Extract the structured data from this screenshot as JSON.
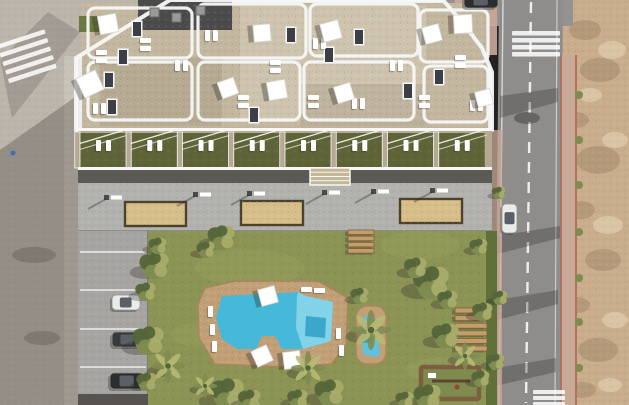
{
  "scene": {
    "title": "aerial-render-apartment-complex-with-pool",
    "type": "3d-architectural-render",
    "view": "top-down"
  },
  "palette": {
    "road_left": "#bcb5ac",
    "sidewalk_left": "#c9c2b8",
    "road_right": "#8e8d8b",
    "road_top": "#95938f",
    "dirt": "#c9ad8c",
    "dirt_dark": "#9f8868",
    "dirt_light": "#e4d4b6",
    "sidewalk_pink": "#c9a998",
    "curb_red": "#ad7560",
    "building_white": "#eceded",
    "parapet": "#f7f8f7",
    "roof_gravel": "#c3b7a0",
    "roof_gravel_light": "#cec4ae",
    "roof_tan": "#b3a78f",
    "roof_dark": "#4b4b4b",
    "roof_green": "#6a7a3e",
    "terrace_green": "#5e6437",
    "terrace_wall": "#b4a992",
    "dark_strip": "#5c5a54",
    "walkway": "#b2b2af",
    "walkway_edge": "#8b8b88",
    "sand": "#d8bf8a",
    "sand_border": "#4d422e",
    "lawn": "#8b9355",
    "lawn_light": "#9aa260",
    "hedge": "#5f7038",
    "pool_deck": "#c2a077",
    "pool_water": "#46b8d9",
    "pool_water_light": "#82d3e8",
    "pool_water_dark": "#2f9fc4",
    "wood": "#c49e68",
    "wood_dark": "#7c5f3f",
    "car_white": "#eaebeb",
    "car_dark": "#37393c",
    "car_black": "#2b2d2f",
    "white": "#ffffff",
    "shadow": "#2e2a27",
    "tree_light": "#a9ac6a",
    "tree_mid": "#7e8c50",
    "tree_dark": "#55653a",
    "palm": "#b6ba74",
    "steps_block": "#c3b795"
  },
  "building": {
    "footprint_points": "170,0 443,0 462,22 482,48 492,72 492,130 76,130 76,58",
    "terrace": {
      "x0": 80,
      "bays": 8,
      "bay_w": 46,
      "gap": 5.25,
      "y": 130,
      "h": 38
    },
    "skylights": [
      {
        "x": 133,
        "y": 22
      },
      {
        "x": 119,
        "y": 50
      },
      {
        "x": 105,
        "y": 73
      },
      {
        "x": 108,
        "y": 100
      },
      {
        "x": 287,
        "y": 28
      },
      {
        "x": 325,
        "y": 48
      },
      {
        "x": 404,
        "y": 84
      },
      {
        "x": 355,
        "y": 30
      },
      {
        "x": 250,
        "y": 108
      },
      {
        "x": 435,
        "y": 70
      }
    ],
    "ac_units": [
      {
        "x": 150,
        "y": 8
      },
      {
        "x": 172,
        "y": 13
      },
      {
        "x": 196,
        "y": 6
      }
    ],
    "parasols": [
      {
        "x": 108,
        "y": 24,
        "s": 13,
        "r": 35
      },
      {
        "x": 90,
        "y": 84,
        "s": 15,
        "r": 20
      },
      {
        "x": 262,
        "y": 33,
        "s": 12,
        "r": 40
      },
      {
        "x": 331,
        "y": 31,
        "s": 13,
        "r": 30
      },
      {
        "x": 228,
        "y": 88,
        "s": 12,
        "r": 25
      },
      {
        "x": 277,
        "y": 90,
        "s": 13,
        "r": 35
      },
      {
        "x": 344,
        "y": 93,
        "s": 12,
        "r": 28
      },
      {
        "x": 432,
        "y": 34,
        "s": 12,
        "r": 30
      },
      {
        "x": 463,
        "y": 24,
        "s": 13,
        "r": 42
      },
      {
        "x": 484,
        "y": 98,
        "s": 11,
        "r": 30
      }
    ],
    "loungers": [
      {
        "x": 96,
        "y": 50,
        "v": 0
      },
      {
        "x": 93,
        "y": 103,
        "v": 1
      },
      {
        "x": 140,
        "y": 38,
        "v": 0
      },
      {
        "x": 205,
        "y": 30,
        "v": 1
      },
      {
        "x": 313,
        "y": 38,
        "v": 1
      },
      {
        "x": 238,
        "y": 95,
        "v": 0
      },
      {
        "x": 308,
        "y": 95,
        "v": 0
      },
      {
        "x": 352,
        "y": 98,
        "v": 1
      },
      {
        "x": 390,
        "y": 60,
        "v": 1
      },
      {
        "x": 419,
        "y": 95,
        "v": 0
      },
      {
        "x": 455,
        "y": 55,
        "v": 0
      },
      {
        "x": 470,
        "y": 100,
        "v": 1
      },
      {
        "x": 175,
        "y": 60,
        "v": 1
      },
      {
        "x": 270,
        "y": 60,
        "v": 0
      }
    ]
  },
  "walkway": {
    "sand_pits": [
      {
        "x": 125,
        "y": 202,
        "w": 61,
        "h": 24
      },
      {
        "x": 241,
        "y": 201,
        "w": 62,
        "h": 24
      },
      {
        "x": 400,
        "y": 199,
        "w": 62,
        "h": 24
      }
    ],
    "benches": [
      {
        "x": 104,
        "y": 195
      },
      {
        "x": 193,
        "y": 192
      },
      {
        "x": 247,
        "y": 191
      },
      {
        "x": 322,
        "y": 190
      },
      {
        "x": 371,
        "y": 189
      },
      {
        "x": 430,
        "y": 188
      }
    ],
    "steps_block": {
      "x": 310,
      "y": 168,
      "w": 40,
      "h": 17
    }
  },
  "pool": {
    "deck_points": "205,288 235,281 318,281 348,298 346,346 331,364 282,367 215,364 199,338 198,305",
    "water_points": "222,296 298,292 306,296 333,302 331,341 303,349 282,349 275,336 262,336 256,349 237,349 222,339 216,318",
    "water_light_points": "298,292 306,296 333,302 331,341 303,349 296,328 297,296",
    "water_step_points": "306,316 326,318 325,338 305,336",
    "parasols": [
      {
        "x": 268,
        "y": 296,
        "s": 12,
        "r": 30
      },
      {
        "x": 262,
        "y": 356,
        "s": 12,
        "r": 20
      },
      {
        "x": 292,
        "y": 360,
        "s": 12,
        "r": 38
      }
    ],
    "loungers": [
      {
        "x": 208,
        "y": 306,
        "v": 1
      },
      {
        "x": 210,
        "y": 324,
        "v": 1
      },
      {
        "x": 212,
        "y": 341,
        "v": 1
      },
      {
        "x": 336,
        "y": 328,
        "v": 1
      },
      {
        "x": 339,
        "y": 345,
        "v": 1
      },
      {
        "x": 301,
        "y": 287,
        "v": 0
      },
      {
        "x": 314,
        "y": 288,
        "v": 0
      }
    ]
  },
  "small_pool": {
    "deck": {
      "x": 356,
      "y": 306,
      "w": 30,
      "h": 58,
      "rx": 11
    },
    "water_points": "364,316 374,316 380,353 377,357 363,354 361,330"
  },
  "lawn": {
    "wood_steps_right": {
      "x": 455,
      "y": 308,
      "w": 32,
      "h": 5,
      "n": 6,
      "dy": 7.6
    },
    "wood_steps_center": {
      "x": 348,
      "y": 230,
      "w": 26,
      "h": 4.5,
      "n": 4,
      "dy": 6.2
    },
    "playground": {
      "x": 421,
      "y": 367,
      "w": 58,
      "h": 32
    },
    "light_patches": [
      {
        "x": 250,
        "y": 268,
        "rx": 55,
        "ry": 18
      },
      {
        "x": 420,
        "y": 245,
        "rx": 40,
        "ry": 14
      },
      {
        "x": 200,
        "y": 335,
        "rx": 30,
        "ry": 12
      },
      {
        "x": 440,
        "y": 370,
        "rx": 35,
        "ry": 12
      }
    ],
    "trees": [
      {
        "x": 155,
        "y": 266,
        "r": 13,
        "t": "bush"
      },
      {
        "x": 146,
        "y": 292,
        "r": 9,
        "t": "bush"
      },
      {
        "x": 149,
        "y": 341,
        "r": 14,
        "t": "bush"
      },
      {
        "x": 168,
        "y": 366,
        "r": 11,
        "t": "palm"
      },
      {
        "x": 147,
        "y": 382,
        "r": 9,
        "t": "bush"
      },
      {
        "x": 158,
        "y": 246,
        "r": 8,
        "t": "bush"
      },
      {
        "x": 222,
        "y": 238,
        "r": 12,
        "t": "bush"
      },
      {
        "x": 206,
        "y": 250,
        "r": 8,
        "t": "bush"
      },
      {
        "x": 228,
        "y": 394,
        "r": 15,
        "t": "bush"
      },
      {
        "x": 250,
        "y": 400,
        "r": 10,
        "t": "bush"
      },
      {
        "x": 205,
        "y": 386,
        "r": 8,
        "t": "palm"
      },
      {
        "x": 308,
        "y": 368,
        "r": 11,
        "t": "palm"
      },
      {
        "x": 330,
        "y": 393,
        "r": 13,
        "t": "bush"
      },
      {
        "x": 298,
        "y": 399,
        "r": 9,
        "t": "bush"
      },
      {
        "x": 371,
        "y": 330,
        "r": 13,
        "t": "palm"
      },
      {
        "x": 360,
        "y": 296,
        "r": 8,
        "t": "bush"
      },
      {
        "x": 432,
        "y": 283,
        "r": 16,
        "t": "bush"
      },
      {
        "x": 416,
        "y": 268,
        "r": 10,
        "t": "bush"
      },
      {
        "x": 448,
        "y": 300,
        "r": 9,
        "t": "bush"
      },
      {
        "x": 446,
        "y": 336,
        "r": 12,
        "t": "bush"
      },
      {
        "x": 465,
        "y": 356,
        "r": 9,
        "t": "palm"
      },
      {
        "x": 428,
        "y": 397,
        "r": 12,
        "t": "bush"
      },
      {
        "x": 405,
        "y": 400,
        "r": 8,
        "t": "bush"
      },
      {
        "x": 479,
        "y": 247,
        "r": 8,
        "t": "bush"
      },
      {
        "x": 483,
        "y": 312,
        "r": 9,
        "t": "bush"
      },
      {
        "x": 481,
        "y": 379,
        "r": 8,
        "t": "bush"
      },
      {
        "x": 499,
        "y": 193,
        "r": 6,
        "t": "bush"
      },
      {
        "x": 500,
        "y": 298,
        "r": 7,
        "t": "bush"
      },
      {
        "x": 496,
        "y": 362,
        "r": 8,
        "t": "bush"
      }
    ]
  },
  "parking": {
    "lines_y": [
      252,
      290,
      329,
      367
    ],
    "cars": [
      {
        "x": 112,
        "y": 295,
        "w": 28,
        "h": 15,
        "c": "car_white"
      },
      {
        "x": 112,
        "y": 332,
        "w": 30,
        "h": 15,
        "c": "car_dark"
      },
      {
        "x": 110,
        "y": 373,
        "w": 34,
        "h": 16,
        "c": "car_black"
      }
    ]
  },
  "roads": {
    "car_right": {
      "x": 502,
      "y": 204,
      "w": 15,
      "h": 29,
      "c": "car_white"
    },
    "car_top": {
      "x": 464,
      "y": -4,
      "w": 34,
      "h": 12,
      "c": "car_black"
    },
    "crosswalks": [
      {
        "x": 2,
        "y": 36,
        "w": 50,
        "h": 4.5,
        "n": 5,
        "dy": 9,
        "rot": -18,
        "cx": 27,
        "cy": 57
      },
      {
        "x": 512,
        "y": 31,
        "w": 48,
        "h": 4.5,
        "n": 4,
        "dy": 7,
        "rot": 0,
        "cx": 0,
        "cy": 0
      },
      {
        "x": 533,
        "y": 390,
        "w": 32,
        "h": 4,
        "n": 3,
        "dy": 6,
        "rot": 0,
        "cx": 0,
        "cy": 0
      }
    ],
    "road_shadows": [
      {
        "points": "500,96 558,88 558,102 500,118"
      },
      {
        "points": "497,236 560,226 560,238 497,254"
      },
      {
        "points": "497,300 558,290 558,304 497,320"
      },
      {
        "points": "495,368 556,358 556,372 495,386"
      }
    ],
    "dirt_blotches": [
      {
        "x": 585,
        "y": 30,
        "rx": 16,
        "ry": 10
      },
      {
        "x": 600,
        "y": 70,
        "rx": 20,
        "ry": 12
      },
      {
        "x": 575,
        "y": 120,
        "rx": 14,
        "ry": 8
      },
      {
        "x": 598,
        "y": 160,
        "rx": 22,
        "ry": 14
      },
      {
        "x": 580,
        "y": 210,
        "rx": 15,
        "ry": 9
      },
      {
        "x": 603,
        "y": 260,
        "rx": 18,
        "ry": 11
      },
      {
        "x": 577,
        "y": 305,
        "rx": 13,
        "ry": 8
      },
      {
        "x": 598,
        "y": 350,
        "rx": 20,
        "ry": 12
      },
      {
        "x": 582,
        "y": 390,
        "rx": 14,
        "ry": 8
      }
    ],
    "dirt_highlights": [
      {
        "x": 612,
        "y": 50,
        "rx": 14,
        "ry": 9
      },
      {
        "x": 590,
        "y": 95,
        "rx": 12,
        "ry": 7
      },
      {
        "x": 615,
        "y": 140,
        "rx": 13,
        "ry": 8
      },
      {
        "x": 608,
        "y": 225,
        "rx": 15,
        "ry": 9
      },
      {
        "x": 615,
        "y": 320,
        "rx": 13,
        "ry": 8
      },
      {
        "x": 610,
        "y": 385,
        "rx": 12,
        "ry": 7
      }
    ],
    "sidewalk_bushes_y": [
      95,
      140,
      185,
      232,
      278,
      322,
      368
    ]
  }
}
